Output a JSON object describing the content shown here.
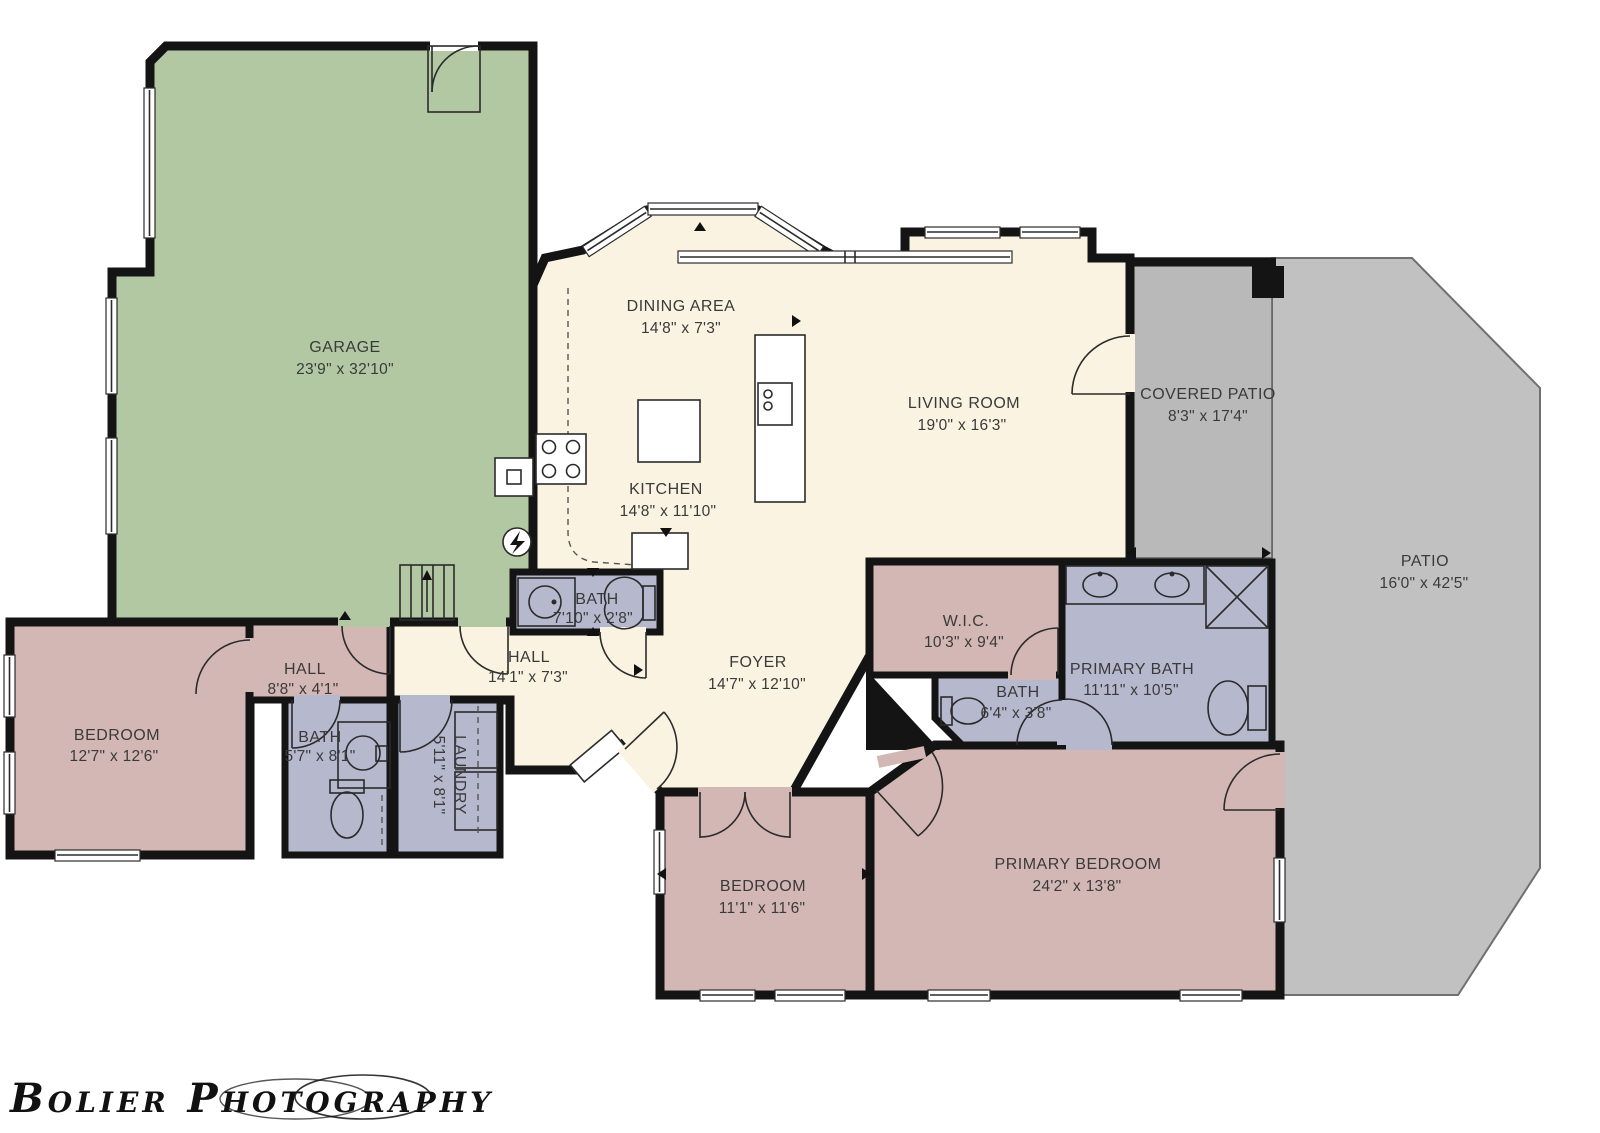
{
  "plan_title": "Single-story residential floor plan",
  "watermark": "Bolier Photography",
  "colors": {
    "garage": "#b2c8a3",
    "living": "#faf3e1",
    "bedroom": "#d3b7b4",
    "bath": "#b6b8ce",
    "patio": "#c1c1c1",
    "covered_patio": "#b9b9b9",
    "wall": "#141414"
  },
  "rooms": [
    {
      "id": "garage",
      "name": "GARAGE",
      "dims": "23'9\" x 32'10\""
    },
    {
      "id": "dining",
      "name": "DINING AREA",
      "dims": "14'8\" x 7'3\""
    },
    {
      "id": "kitchen",
      "name": "KITCHEN",
      "dims": "14'8\" x 11'10\""
    },
    {
      "id": "living",
      "name": "LIVING ROOM",
      "dims": "19'0\" x 16'3\""
    },
    {
      "id": "covered-patio",
      "name": "COVERED PATIO",
      "dims": "8'3\" x 17'4\""
    },
    {
      "id": "patio",
      "name": "PATIO",
      "dims": "16'0\" x 42'5\""
    },
    {
      "id": "hall-bath",
      "name": "BATH",
      "dims": "7'10\" x 2'8\""
    },
    {
      "id": "hall-left",
      "name": "HALL",
      "dims": "8'8\" x 4'1\""
    },
    {
      "id": "hall-main",
      "name": "HALL",
      "dims": "14'1\" x 7'3\""
    },
    {
      "id": "foyer",
      "name": "FOYER",
      "dims": "14'7\" x 12'10\""
    },
    {
      "id": "wic",
      "name": "W.I.C.",
      "dims": "10'3\" x 9'4\""
    },
    {
      "id": "primary-bath",
      "name": "PRIMARY BATH",
      "dims": "11'11\" x 10'5\""
    },
    {
      "id": "primary-wc",
      "name": "BATH",
      "dims": "6'4\" x 3'8\""
    },
    {
      "id": "bedroom-left",
      "name": "BEDROOM",
      "dims": "12'7\" x 12'6\""
    },
    {
      "id": "guest-bath",
      "name": "BATH",
      "dims": "5'7\" x 8'1\""
    },
    {
      "id": "laundry",
      "name": "LAUNDRY",
      "dims": "5'11\" x 8'1\""
    },
    {
      "id": "bedroom-front",
      "name": "BEDROOM",
      "dims": "11'1\" x 11'6\""
    },
    {
      "id": "primary-bedroom",
      "name": "PRIMARY BEDROOM",
      "dims": "24'2\" x 13'8\""
    }
  ]
}
